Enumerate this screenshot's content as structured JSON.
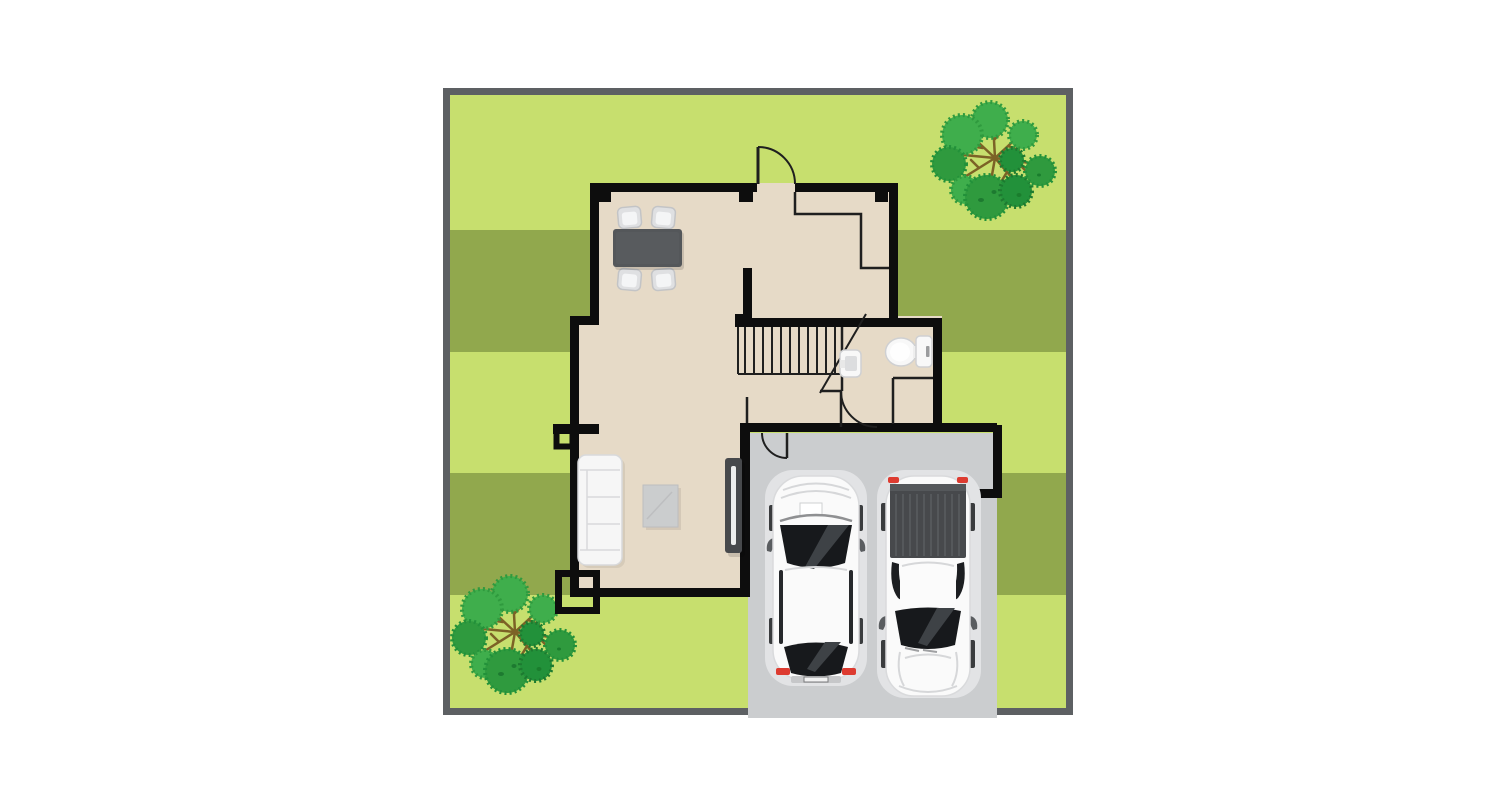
{
  "scene": {
    "type": "floor-plan-illustration",
    "description": "Top-down architectural illustration of a house ground floor on a striped lawn lot with two trees, a two-car garage and driveway with a white sedan and a white pickup truck"
  },
  "colors": {
    "page_bg": "#ffffff",
    "border": "#5d6063",
    "lawn": "#c7df6e",
    "stripe": "#91a84d",
    "floor": "#e6dac7",
    "wall": "#0d0d0d",
    "thin": "#1f1f1f",
    "garage": "#cbcdcf",
    "halo": "#e2e3e5",
    "car_white": "#fafafa",
    "car_shade": "#d9dadc",
    "window": "#17191c",
    "window_reflection": "#3e4246",
    "bed": "#47494c",
    "bed_stripe": "#55585b",
    "taillight": "#dd3b30",
    "table": "#54575a",
    "chair": "#dfe0e2",
    "chair_back": "#c3c4c6",
    "sofa": "#f6f6f6",
    "sofa_line": "#d8d9db",
    "ottoman": "#cbcdce",
    "tv": "#47494c",
    "tv_screen": "#eceded",
    "fixture": "#f8f8f8",
    "fixture_line": "#cfd0d2",
    "leaf": "#3fae4c",
    "leaf_dark": "#2f9a3e",
    "leaf_darker": "#22913a",
    "branch": "#7c6226"
  },
  "objects": [
    {
      "id": "yard",
      "label": "fenced lawn lot with mowing stripes"
    },
    {
      "id": "house",
      "label": "house ground-floor plan"
    },
    {
      "id": "dining-set",
      "label": "dining table with four chairs"
    },
    {
      "id": "sofa",
      "label": "three-seat sofa"
    },
    {
      "id": "ottoman",
      "label": "ottoman rug"
    },
    {
      "id": "tv-console",
      "label": "tv console"
    },
    {
      "id": "stairs",
      "label": "staircase"
    },
    {
      "id": "bathroom",
      "label": "bathroom with toilet and sink"
    },
    {
      "id": "garage",
      "label": "garage and driveway"
    },
    {
      "id": "sedan",
      "label": "white sedan parked facing house"
    },
    {
      "id": "pickup",
      "label": "white pickup truck parked facing street"
    },
    {
      "id": "tree-top",
      "label": "tree in back yard"
    },
    {
      "id": "tree-bottom",
      "label": "tree in side yard"
    }
  ]
}
